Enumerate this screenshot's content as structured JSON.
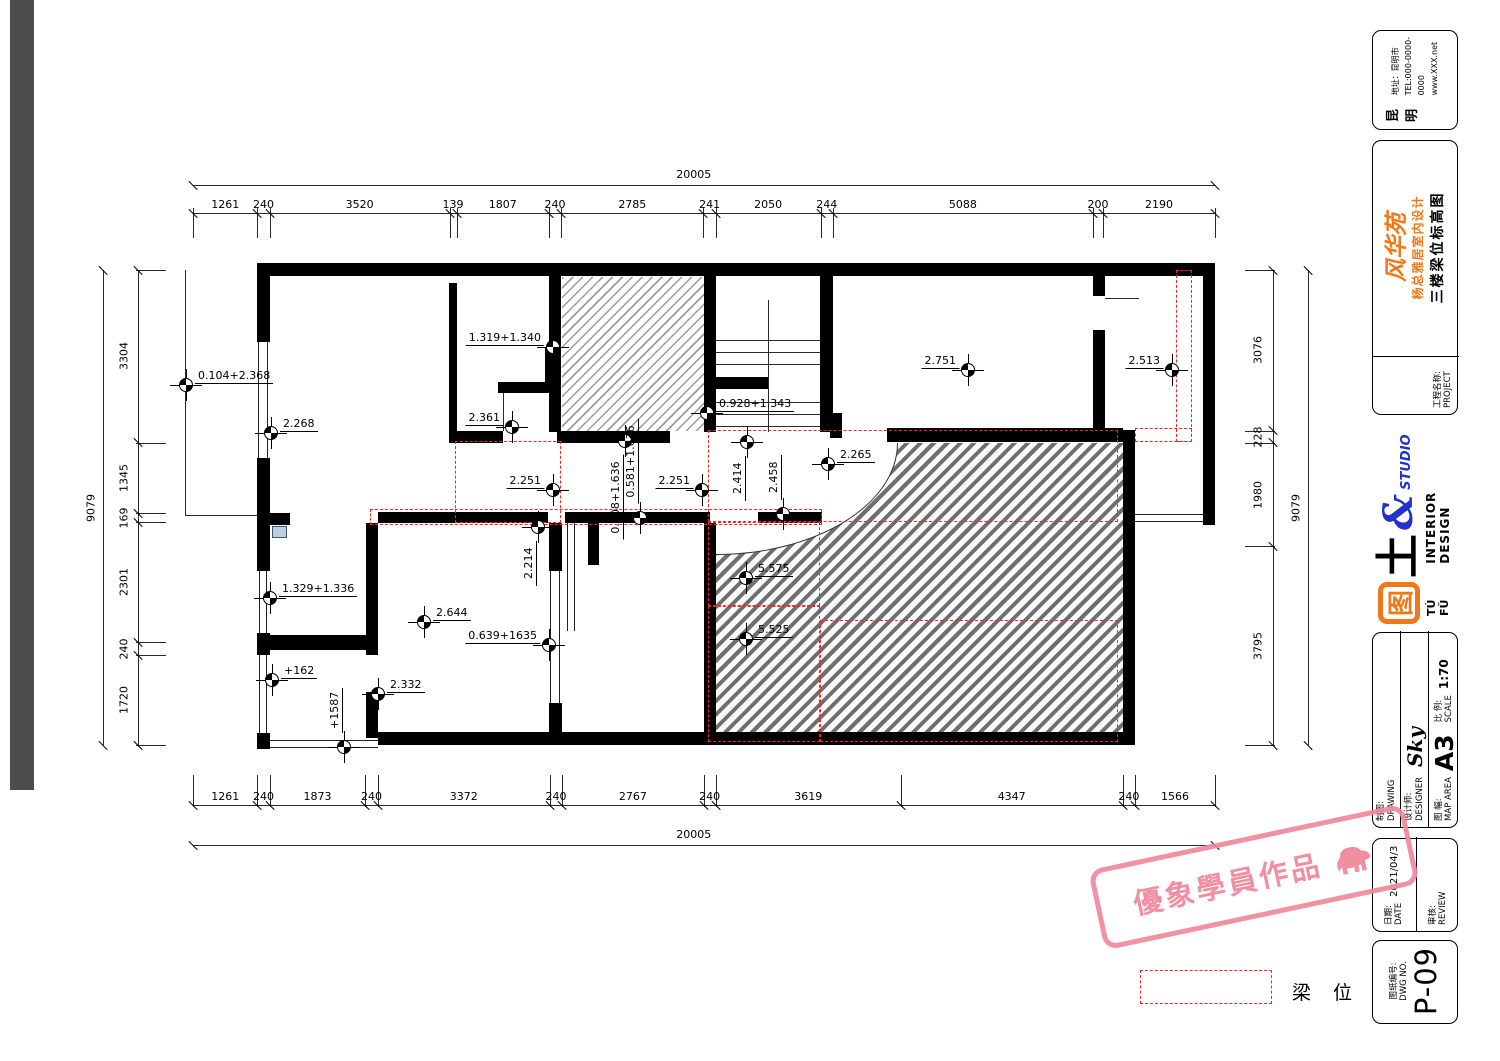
{
  "legend": {
    "label": "梁 位"
  },
  "stamp": {
    "text": "優象學員作品",
    "icon": "elephant-icon"
  },
  "title_block": {
    "contact": {
      "region": "昆明",
      "address": "地址：昆明市",
      "tel": "TEL:000-0000-0000",
      "web": "www.XXX.net"
    },
    "project": {
      "label_cn": "工程名称:",
      "label_en": "PROJECT",
      "logo_script": "风华苑",
      "subtitle": "杨总雅居室内设计",
      "drawing_title": "三楼梁位标高图"
    },
    "studio": {
      "tu_glyph": "图",
      "tu2": "土",
      "amp": "&",
      "studio": "STUDIO",
      "pinyin": "TÚ FǓ",
      "tagline": "INTERIOR DESIGN"
    },
    "info": {
      "drawing_cn": "制图:",
      "drawing_en": "DRAWING",
      "designer_cn": "设计师:",
      "designer_en": "DESIGNER",
      "designer_value": "Sky",
      "map_cn": "图 幅:",
      "map_en": "MAP AREA",
      "map_value": "A3",
      "scale_cn": "比 例:",
      "scale_en": "SCALE",
      "scale_value": "1:70"
    },
    "dates": {
      "date_cn": "日期:",
      "date_en": "DATE",
      "date_value": "2021/04/3",
      "review_cn": "审核:",
      "review_en": "REVIEW"
    },
    "dwg": {
      "no_cn": "图纸编号:",
      "no_en": "DWG NO.",
      "value": "P-09"
    }
  },
  "drawing": {
    "colors": {
      "beam": "#ff2020",
      "accent_orange": "#f07818",
      "accent_blue": "#2233cc",
      "stamp_pink": "#f0889b"
    },
    "dim_top": {
      "total": 20005,
      "segments": [
        1261,
        240,
        3520,
        139,
        1807,
        240,
        2785,
        241,
        2050,
        244,
        5088,
        200,
        2190
      ]
    },
    "dim_bottom": {
      "total": 20005,
      "segments": [
        1261,
        240,
        1873,
        240,
        3372,
        240,
        2767,
        240,
        3619,
        4347,
        240,
        1566
      ]
    },
    "dim_left": {
      "total": 9079,
      "segments": [
        3304,
        1345,
        169,
        2301,
        240,
        1720
      ]
    },
    "dim_right": {
      "total": 9079,
      "segments": [
        3076,
        228,
        1980,
        3795
      ]
    },
    "elevation_marks": [
      {
        "label": "0.104+2.368",
        "x": 186,
        "y": 385,
        "side": "r"
      },
      {
        "label": "2.268",
        "x": 271,
        "y": 433,
        "side": "r"
      },
      {
        "label": "1.319+1.340",
        "x": 553,
        "y": 347,
        "side": "l"
      },
      {
        "label": "2.361",
        "x": 512,
        "y": 427,
        "side": "l"
      },
      {
        "label": "0.928+1.343",
        "x": 707,
        "y": 413,
        "side": "r"
      },
      {
        "label": "2.751",
        "x": 968,
        "y": 370,
        "side": "l"
      },
      {
        "label": "2.513",
        "x": 1172,
        "y": 370,
        "side": "l"
      },
      {
        "label": "2.251",
        "x": 553,
        "y": 490,
        "side": "l"
      },
      {
        "label": "2.251",
        "x": 702,
        "y": 490,
        "side": "l"
      },
      {
        "label": "0.708+1.636",
        "x": 625,
        "y": 441,
        "side": "vb"
      },
      {
        "label": "0.581+1.636",
        "x": 640,
        "y": 518,
        "side": "va"
      },
      {
        "label": "2.414",
        "x": 747,
        "y": 442,
        "side": "vb"
      },
      {
        "label": "2.458",
        "x": 783,
        "y": 514,
        "side": "va"
      },
      {
        "label": "2.265",
        "x": 828,
        "y": 464,
        "side": "r"
      },
      {
        "label": "2.214",
        "x": 538,
        "y": 527,
        "side": "vb"
      },
      {
        "label": "1.329+1.336",
        "x": 270,
        "y": 598,
        "side": "r"
      },
      {
        "label": "2.644",
        "x": 424,
        "y": 622,
        "side": "r"
      },
      {
        "label": "0.639+1635",
        "x": 549,
        "y": 645,
        "side": "l"
      },
      {
        "label": "+162",
        "x": 272,
        "y": 680,
        "side": "r"
      },
      {
        "label": "2.332",
        "x": 378,
        "y": 694,
        "side": "r"
      },
      {
        "label": "+1587",
        "x": 344,
        "y": 747,
        "side": "va"
      },
      {
        "label": "5.575",
        "x": 746,
        "y": 578,
        "side": "r"
      },
      {
        "label": "5.525",
        "x": 746,
        "y": 639,
        "side": "r"
      }
    ],
    "walls": [
      [
        257,
        263,
        958,
        13
      ],
      [
        257,
        276,
        13,
        66
      ],
      [
        257,
        458,
        13,
        57
      ],
      [
        257,
        513,
        33,
        12
      ],
      [
        257,
        523,
        13,
        48
      ],
      [
        257,
        633,
        13,
        22
      ],
      [
        257,
        733,
        13,
        16
      ],
      [
        366,
        523,
        12,
        132
      ],
      [
        366,
        692,
        12,
        46
      ],
      [
        258,
        635,
        112,
        15
      ],
      [
        378,
        732,
        757,
        13
      ],
      [
        549,
        523,
        13,
        48
      ],
      [
        549,
        703,
        13,
        42
      ],
      [
        449,
        283,
        8,
        148
      ],
      [
        549,
        276,
        12,
        156
      ],
      [
        545,
        347,
        12,
        46
      ],
      [
        498,
        382,
        60,
        11
      ],
      [
        704,
        276,
        12,
        156
      ],
      [
        820,
        276,
        13,
        156
      ],
      [
        704,
        523,
        12,
        221
      ],
      [
        1123,
        430,
        12,
        314
      ],
      [
        887,
        428,
        236,
        14
      ],
      [
        830,
        413,
        12,
        25
      ],
      [
        1093,
        276,
        12,
        20
      ],
      [
        1093,
        330,
        12,
        102
      ],
      [
        1203,
        263,
        12,
        262
      ],
      [
        449,
        431,
        54,
        12
      ],
      [
        557,
        431,
        113,
        12
      ],
      [
        378,
        512,
        170,
        11
      ],
      [
        565,
        512,
        145,
        11
      ],
      [
        758,
        512,
        64,
        11
      ],
      [
        588,
        523,
        11,
        42
      ],
      [
        716,
        377,
        52,
        12
      ]
    ],
    "windows": [
      [
        "v",
        258,
        340,
        10,
        120
      ],
      [
        "v",
        259,
        571,
        8,
        62
      ],
      [
        "v",
        259,
        655,
        8,
        78
      ],
      [
        "v",
        550,
        571,
        10,
        132
      ],
      [
        "v",
        567,
        523,
        8,
        108
      ],
      [
        "h",
        257,
        740,
        121,
        8
      ],
      [
        "h",
        1135,
        514,
        68,
        8
      ]
    ],
    "lines": [
      [
        185,
        270,
        1,
        246
      ],
      [
        185,
        515,
        72,
        1
      ],
      [
        768,
        300,
        1,
        132
      ],
      [
        716,
        340,
        104,
        1
      ],
      [
        716,
        352,
        104,
        1
      ],
      [
        716,
        364,
        104,
        1
      ],
      [
        716,
        402,
        104,
        1
      ],
      [
        716,
        414,
        104,
        1
      ],
      [
        716,
        426,
        104,
        1
      ],
      [
        503,
        390,
        1,
        41
      ],
      [
        1105,
        298,
        34,
        1
      ]
    ],
    "beam_zones": [
      [
        455,
        441,
        106,
        82
      ],
      [
        370,
        509,
        452,
        16
      ],
      [
        708,
        430,
        410,
        92
      ],
      [
        708,
        522,
        112,
        84
      ],
      [
        708,
        606,
        112,
        136
      ],
      [
        820,
        620,
        298,
        122
      ],
      [
        1176,
        270,
        16,
        172
      ],
      [
        1135,
        428,
        57,
        14
      ]
    ],
    "hatch_light": [
      562,
      277,
      142,
      154
    ],
    "hatch_dark": [
      716,
      443,
      407,
      289
    ],
    "arc_cut": [
      716,
      443,
      182,
      112
    ],
    "blue_box": [
      272,
      526,
      15,
      12
    ]
  }
}
